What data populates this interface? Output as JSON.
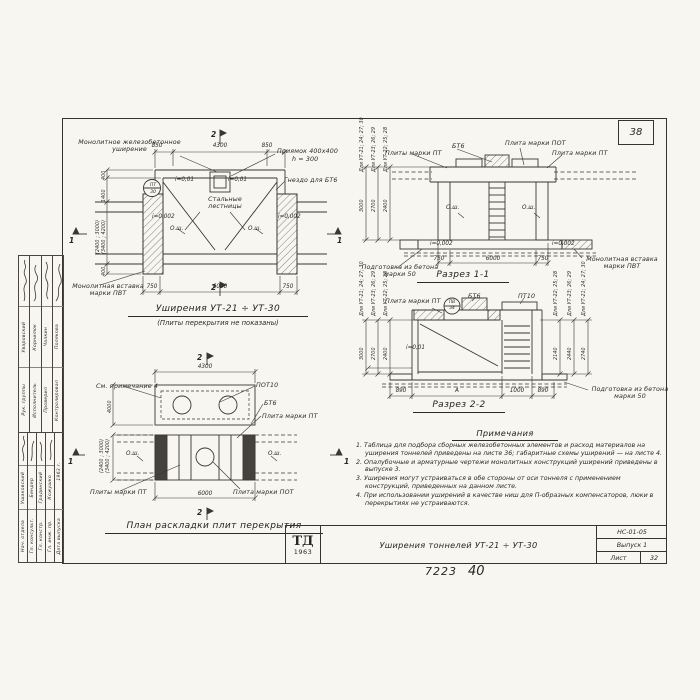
{
  "sheet": {
    "corner_number": "38",
    "footer_left": "7223",
    "footer_right": "40"
  },
  "titleblock": {
    "logo_top": "ТД",
    "logo_year": "1963",
    "title": "Уширения тоннелей УТ-21 ÷ УТ-30",
    "code": "НС-01-05",
    "issue": "Выпуск 1",
    "sheet_label": "Лист",
    "sheet_number": "32"
  },
  "stamp": {
    "top": [
      {
        "role": "Рук. группы",
        "name": "Уваровский"
      },
      {
        "role": "Исполнитель",
        "name": "Корнилюк"
      },
      {
        "role": "Проверил",
        "name": "Чалкин"
      },
      {
        "role": "Контролировал",
        "name": "Полякова"
      }
    ],
    "bottom": [
      {
        "role": "Нач. отдела",
        "name": "Ушаковский"
      },
      {
        "role": "Гл. консульт.",
        "name": "Бендер"
      },
      {
        "role": "Гл. констр.",
        "name": "Градинский"
      },
      {
        "role": "Гл. инж. пр.",
        "name": "Кожушко"
      },
      {
        "role": "Дата выпуска",
        "name": "1963 г."
      }
    ]
  },
  "plan_widening": {
    "title": "Уширения УТ-21 ÷ УТ-30",
    "subtitle": "(Плиты перекрытия не показаны)",
    "label_widening": "Монолитное железобетонное уширение",
    "label_pit_1": "Приямок 400х400",
    "label_pit_2": "h = 300",
    "label_socket": "Гнездо для БТ6",
    "label_stairs": "Стальные лестницы",
    "label_insert": "Монолитная вставка марки ПВТ",
    "mark_top": "ПТ",
    "mark_bottom": "30",
    "slope_top": "i=0,01",
    "slope_side": "i=0,002",
    "axis": "О.ш.",
    "dim_top": [
      "850",
      "4300",
      "850"
    ],
    "dim_bottom": [
      "750",
      "6000",
      "750"
    ],
    "dim_left": [
      "400",
      "1400",
      "(2400 ; 3000)",
      "(3400 ; 4200)",
      "400"
    ],
    "mark_1": "1",
    "mark_2": "2"
  },
  "section_1_1": {
    "title": "Разрез 1-1",
    "label_bt6": "БТ6",
    "label_pot": "Плита марки ПОТ",
    "label_pts": "Плиты марки ПТ",
    "label_pt": "Плита марки ПТ",
    "label_prep": "Подготовка из бетона марки 50",
    "label_insert": "Монолитная вставка марки ПВТ",
    "slope": "i=0,002",
    "axis": "О.ш.",
    "variants": [
      {
        "label": "Для УТ-21; 24; 27; 30",
        "dim": "3000"
      },
      {
        "label": "Для УТ-23; 26; 29",
        "dim": "2700"
      },
      {
        "label": "Для УТ-22; 25; 28",
        "dim": "2400"
      }
    ],
    "dim_bottom": [
      "750",
      "6000",
      "750"
    ]
  },
  "section_2_2": {
    "title": "Разрез 2-2",
    "label_pt": "Плита марки ПТ",
    "label_bt6": "БТ6",
    "label_pt10": "ПТ10",
    "label_prep": "Подготовка из бетона марки 50",
    "slope": "i=0,01",
    "mark_top": "ПВ",
    "mark_bottom": "34",
    "variants_left": [
      {
        "label": "Для УТ-21; 24; 27; 30",
        "dim": "3000"
      },
      {
        "label": "Для УТ-23; 26; 29",
        "dim": "2700"
      },
      {
        "label": "Для УТ-22; 25; 28",
        "dim": "2400"
      }
    ],
    "variants_right": [
      {
        "label": "Для УТ-22; 25; 28",
        "dim": "2140"
      },
      {
        "label": "Для УТ-23; 26; 29",
        "dim": "2440"
      },
      {
        "label": "Для УТ-21; 24; 27; 30",
        "dim": "2740"
      }
    ],
    "dim_bottom": [
      "890",
      "А",
      "1000",
      "890"
    ]
  },
  "plan_plates": {
    "title": "План раскладки плит перекрытия",
    "label_note": "См. примечание 4",
    "label_pot10": "ПОТ10",
    "label_bt6": "БТ6",
    "label_pt": "Плита марки ПТ",
    "label_pts": "Плиты марки ПТ",
    "label_pot": "Плита марки ПОТ",
    "axis": "О.ш.",
    "dim_top": "4300",
    "dim_bottom": "6000",
    "dim_left_1": "4000",
    "dim_left_2": "(2400 ; 3000)",
    "dim_left_3": "(3400 ; 4200)",
    "mark_1": "1",
    "mark_2": "2"
  },
  "notes": {
    "heading": "Примечания",
    "items": [
      "1. Таблица для подбора сборных железобетонных элементов и расход материалов на уширения тоннелей приведены на листе 36; габаритные схемы уширений — на листе 4.",
      "2. Опалубочные и арматурные чертежи монолитных конструкций уширений приведены в выпуске 3.",
      "3. Уширения могут устраиваться в обе стороны от оси тоннеля с применением конструкций, приведенных на данном листе.",
      "4. При использовании уширений в качестве ниш для П-образных компенсаторов, люки в перекрытиях не устраиваются."
    ]
  }
}
